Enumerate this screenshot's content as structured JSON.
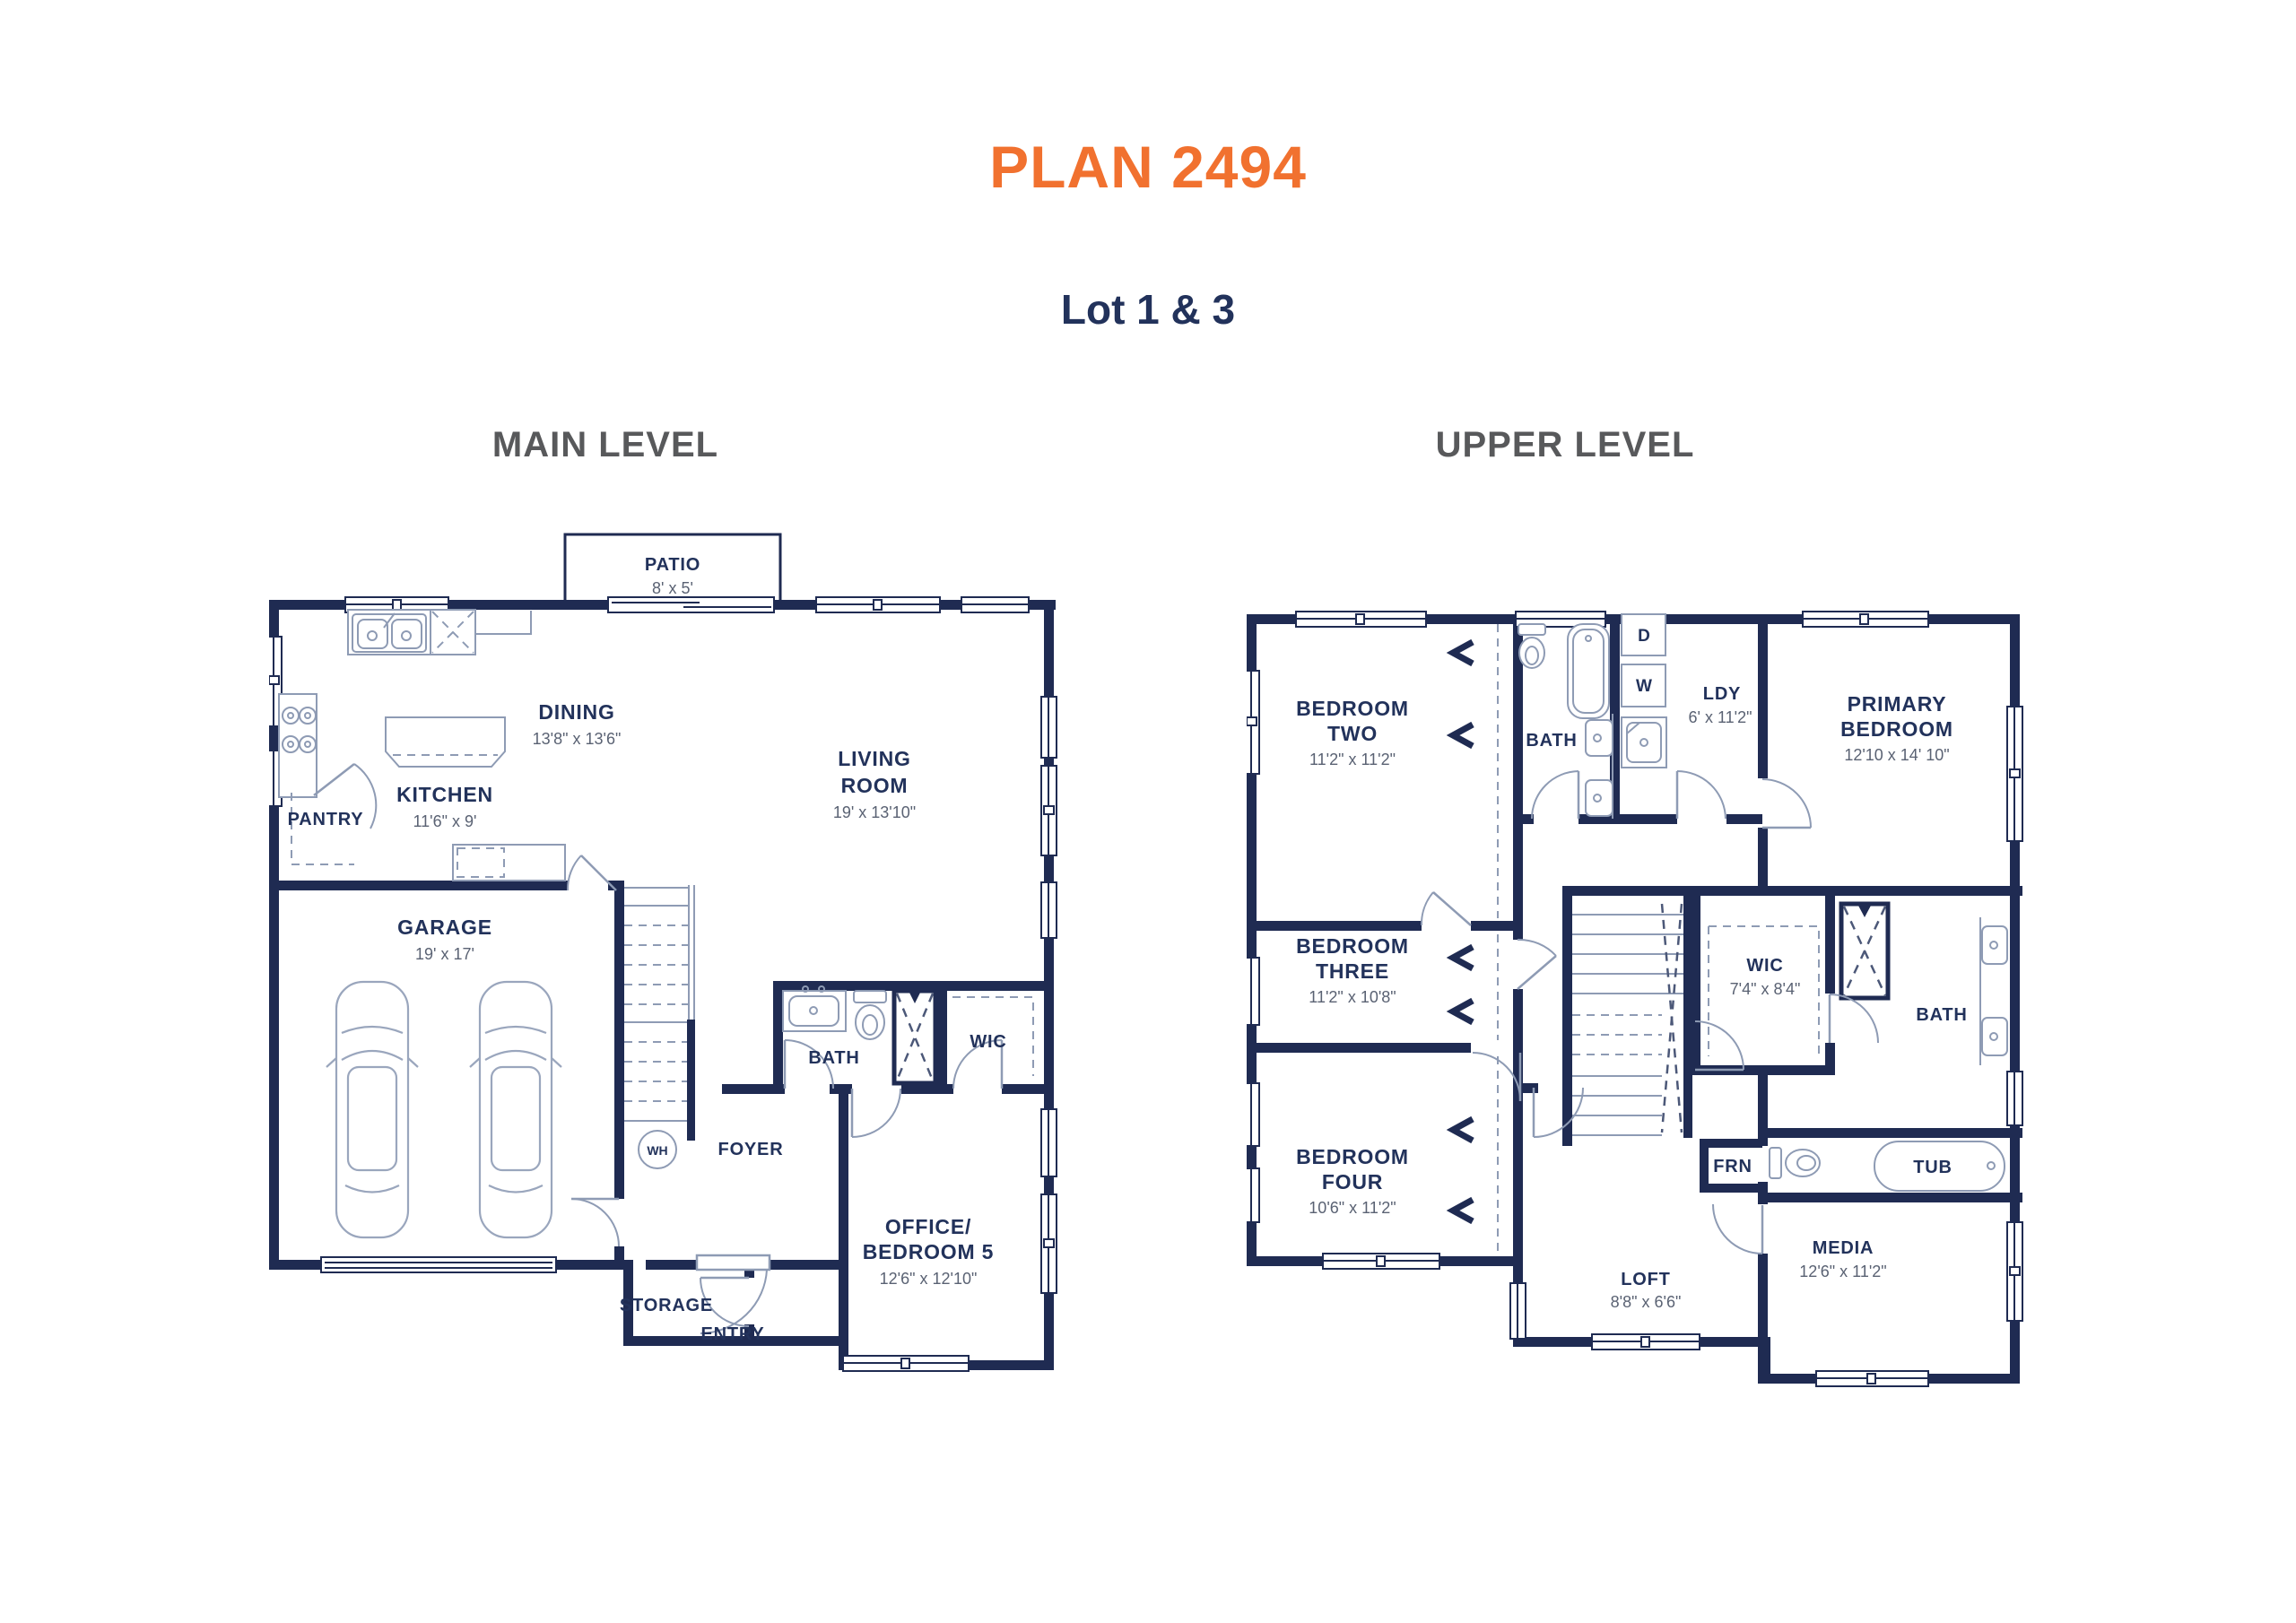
{
  "page": {
    "title": "PLAN 2494",
    "subtitle": "Lot 1 & 3",
    "accent_color": "#F1712F",
    "wall_color": "#1F2B52",
    "heading_color": "#58595B"
  },
  "main_level": {
    "heading": "MAIN LEVEL",
    "rooms": {
      "patio": {
        "name": "PATIO",
        "dims": "8' x 5'"
      },
      "dining": {
        "name": "DINING",
        "dims": "13'8\" x 13'6\""
      },
      "kitchen": {
        "name": "KITCHEN",
        "dims": "11'6\" x 9'"
      },
      "pantry": {
        "name": "PANTRY"
      },
      "living_room": {
        "lines": [
          "LIVING",
          "ROOM"
        ],
        "dims": "19' x 13'10\""
      },
      "garage": {
        "name": "GARAGE",
        "dims": "19' x 17'"
      },
      "bath": {
        "name": "BATH"
      },
      "wic": {
        "name": "WIC"
      },
      "foyer": {
        "name": "FOYER"
      },
      "storage": {
        "name": "STORAGE"
      },
      "entry": {
        "name": "ENTRY"
      },
      "office": {
        "lines": [
          "OFFICE/",
          "BEDROOM 5"
        ],
        "dims": "12'6\" x 12'10\""
      },
      "water_heater": {
        "name": "WH"
      }
    }
  },
  "upper_level": {
    "heading": "UPPER LEVEL",
    "rooms": {
      "bedroom_two": {
        "lines": [
          "BEDROOM",
          "TWO"
        ],
        "dims": "11'2\" x 11'2\""
      },
      "hall_bath": {
        "name": "BATH"
      },
      "laundry": {
        "name": "LDY",
        "dims": "6' x 11'2\""
      },
      "dryer": {
        "name": "D"
      },
      "washer": {
        "name": "W"
      },
      "primary_bedroom": {
        "lines": [
          "PRIMARY",
          "BEDROOM"
        ],
        "dims": "12'10 x 14' 10\""
      },
      "bedroom_three": {
        "lines": [
          "BEDROOM",
          "THREE"
        ],
        "dims": "11'2\" x 10'8\""
      },
      "bedroom_four": {
        "lines": [
          "BEDROOM",
          "FOUR"
        ],
        "dims": "10'6\" x 11'2\""
      },
      "wic": {
        "name": "WIC",
        "dims": "7'4\" x 8'4\""
      },
      "primary_bath": {
        "name": "BATH"
      },
      "tub": {
        "name": "TUB"
      },
      "furnace": {
        "name": "FRN"
      },
      "loft": {
        "name": "LOFT",
        "dims": "8'8\" x 6'6\""
      },
      "media": {
        "name": "MEDIA",
        "dims": "12'6\" x 11'2\""
      }
    }
  }
}
